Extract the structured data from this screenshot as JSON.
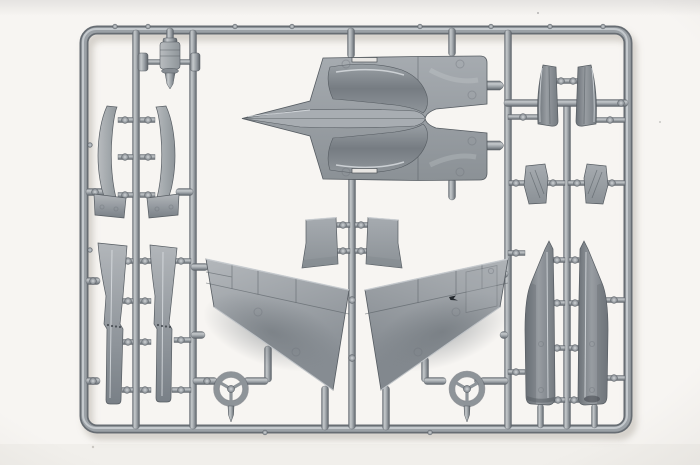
{
  "scene": {
    "type": "photograph",
    "subject": "Gray injection-molded plastic model kit sprue (parts tree) with unassembled jet aircraft parts",
    "background": "white seamless studio backdrop",
    "visible_text": ""
  },
  "palette": {
    "backdrop": "#f7f5f2",
    "backdrop_top_band": "#e9e7e4",
    "backdrop_shadow": "#ccc8c1",
    "plastic_light": "#c9cdd1",
    "plastic_mid": "#9ba1a6",
    "plastic_dark": "#5f656b"
  },
  "sprue": {
    "frame": "rectangular runner frame with rounded corners and internal runner rails",
    "parts": [
      {
        "name": "upper-fuselage-shell",
        "count": 1,
        "desc": "large upper fuselage half with pointed nose spine, twin engine bulges and split rear decks"
      },
      {
        "name": "main-wing-panel",
        "count": 2,
        "desc": "large swept wing skins converging toward bottom center"
      },
      {
        "name": "stabilizer",
        "count": 2,
        "desc": "small trapezoidal tailplane parts flanking the center runner"
      },
      {
        "name": "canopy-rail",
        "count": 2,
        "desc": "curved blade-shaped parts with flared feet, upper left"
      },
      {
        "name": "flap",
        "count": 2,
        "desc": "long tapered trailing-edge strips with hinge detail, lower left"
      },
      {
        "name": "intake-trunk",
        "count": 2,
        "desc": "long spiked duct parts, lower right"
      },
      {
        "name": "nozzle-half",
        "count": 2,
        "desc": "tapered exhaust nozzle halves, upper right"
      },
      {
        "name": "intake-ramp",
        "count": 2,
        "desc": "small wedge-shaped ramp parts, mid right"
      },
      {
        "name": "wheel-ring",
        "count": 2,
        "desc": "three-spoke steering-wheel-like rings near the bottom"
      },
      {
        "name": "nose-pin",
        "count": 2,
        "desc": "small pointed pins hanging below the wheel rings"
      },
      {
        "name": "equipment-cylinder",
        "count": 1,
        "desc": "small banded cylindrical part at top left"
      }
    ]
  }
}
